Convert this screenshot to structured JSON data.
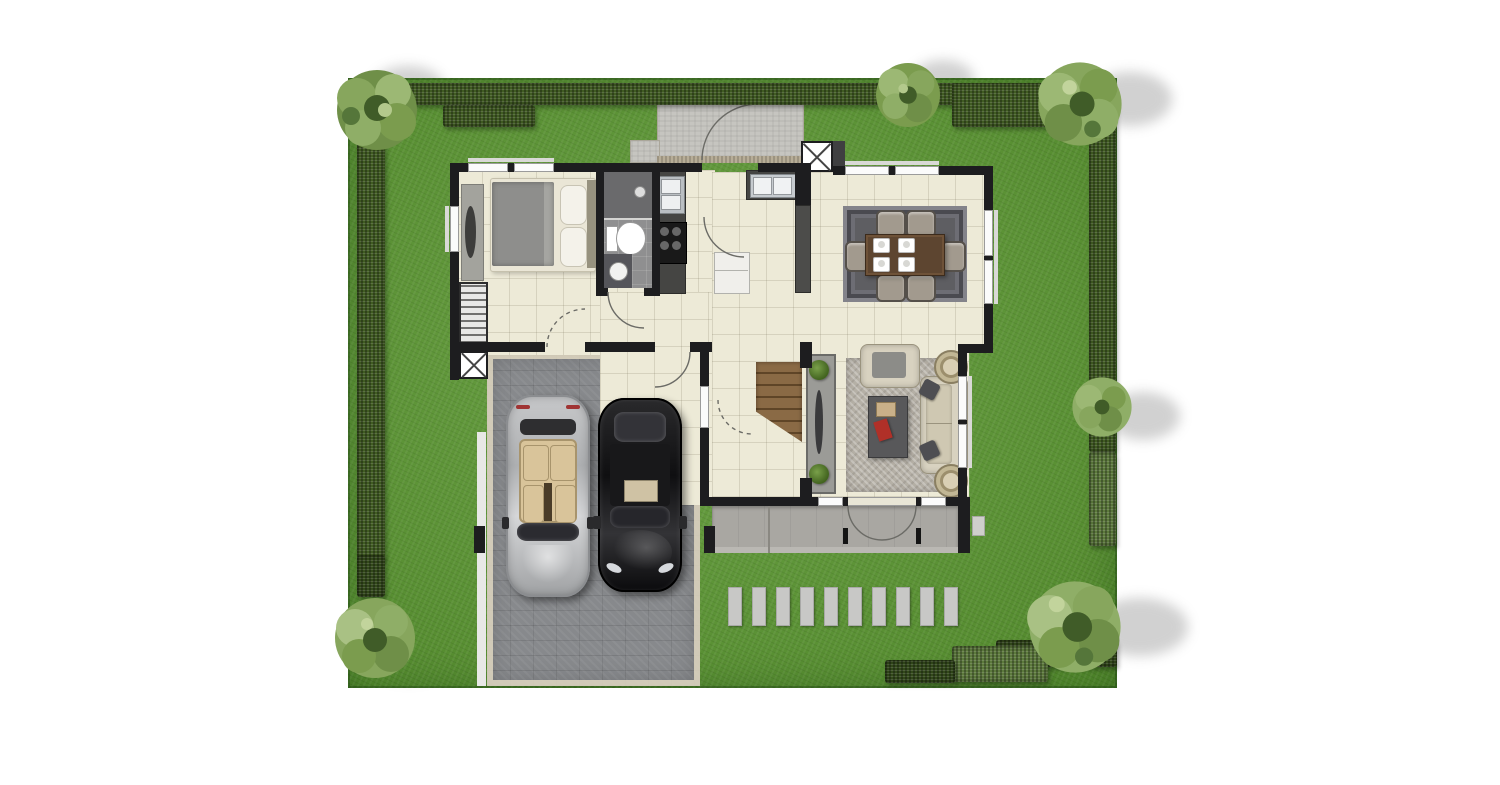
{
  "meta": {
    "description": "Top-down rendered residential floor plan: single-storey house with bedroom, bathroom, kitchen, dining and living areas, entry porch, rear terrace, stair hall, and a paved driveway garage with two parked cars, set in a lawn bordered by hedges and trees",
    "canvas": {
      "width": 1500,
      "height": 785
    }
  },
  "palette": {
    "background": "#ffffff",
    "lawn_green": "#5a9730",
    "hedge_green": "#415c23",
    "hedge_light_green": "#5d7a3d",
    "floor_cream": "#edead7",
    "wall_black": "#1d1d1f",
    "driveway_grey": "#87898c",
    "terrace_grey": "#a9a7a2",
    "porch_grey": "#c6c5c0",
    "rug_dark_grey": "#5e5e62",
    "rug_light_grey": "#b5b0a6",
    "table_wood_brown": "#5d4530",
    "stair_wood_brown": "#8a6a45",
    "car_silver": "#b9babc",
    "car_black": "#141416",
    "car_interior_beige": "#d9c49a",
    "accent_red": "#b03028"
  },
  "garden": {
    "lawn": {
      "name": "lawn"
    },
    "hedges": [
      {
        "name": "hedge-top"
      },
      {
        "name": "hedge-top-left-inner"
      },
      {
        "name": "hedge-top-right-deep"
      },
      {
        "name": "hedge-left"
      },
      {
        "name": "hedge-right-upper"
      },
      {
        "name": "hedge-right-lower"
      },
      {
        "name": "hedge-bottom-dark"
      },
      {
        "name": "hedge-bottom-light"
      }
    ],
    "trees": [
      {
        "name": "tree-top-left"
      },
      {
        "name": "tree-top-center"
      },
      {
        "name": "tree-top-right"
      },
      {
        "name": "tree-right-middle"
      },
      {
        "name": "tree-bottom-left"
      },
      {
        "name": "tree-bottom-right"
      }
    ],
    "stepping_stones_count": 10
  },
  "house": {
    "rooms": [
      {
        "name": "bedroom",
        "furniture": [
          "double-bed",
          "pillows",
          "headboard",
          "side-bench",
          "wardrobe"
        ]
      },
      {
        "name": "bathroom",
        "furniture": [
          "shower",
          "toilet",
          "wash-basin"
        ]
      },
      {
        "name": "kitchen",
        "furniture": [
          "sink-counter",
          "four-burner-stove",
          "double-sink-counter",
          "fridge",
          "pantry-unit"
        ]
      },
      {
        "name": "dining-area",
        "furniture": [
          "area-rug",
          "dining-table",
          "place-settings-4",
          "chairs-6"
        ]
      },
      {
        "name": "living-room",
        "furniture": [
          "area-rug",
          "armchair",
          "sofa",
          "coffee-table",
          "side-table-2"
        ]
      },
      {
        "name": "stair-hall",
        "furniture": [
          "staircase",
          "console-with-plants"
        ]
      }
    ],
    "utilities": [
      {
        "name": "washer-porch"
      },
      {
        "name": "washer-side-niche"
      },
      {
        "name": "ac-pad"
      }
    ],
    "outdoor": [
      {
        "name": "entry-porch"
      },
      {
        "name": "rear-terrace"
      },
      {
        "name": "driveway"
      }
    ]
  },
  "vehicles": [
    {
      "name": "silver-convertible",
      "color": "#b9babc",
      "orientation": "facing-down"
    },
    {
      "name": "black-sedan",
      "color": "#141416",
      "orientation": "facing-down"
    }
  ]
}
